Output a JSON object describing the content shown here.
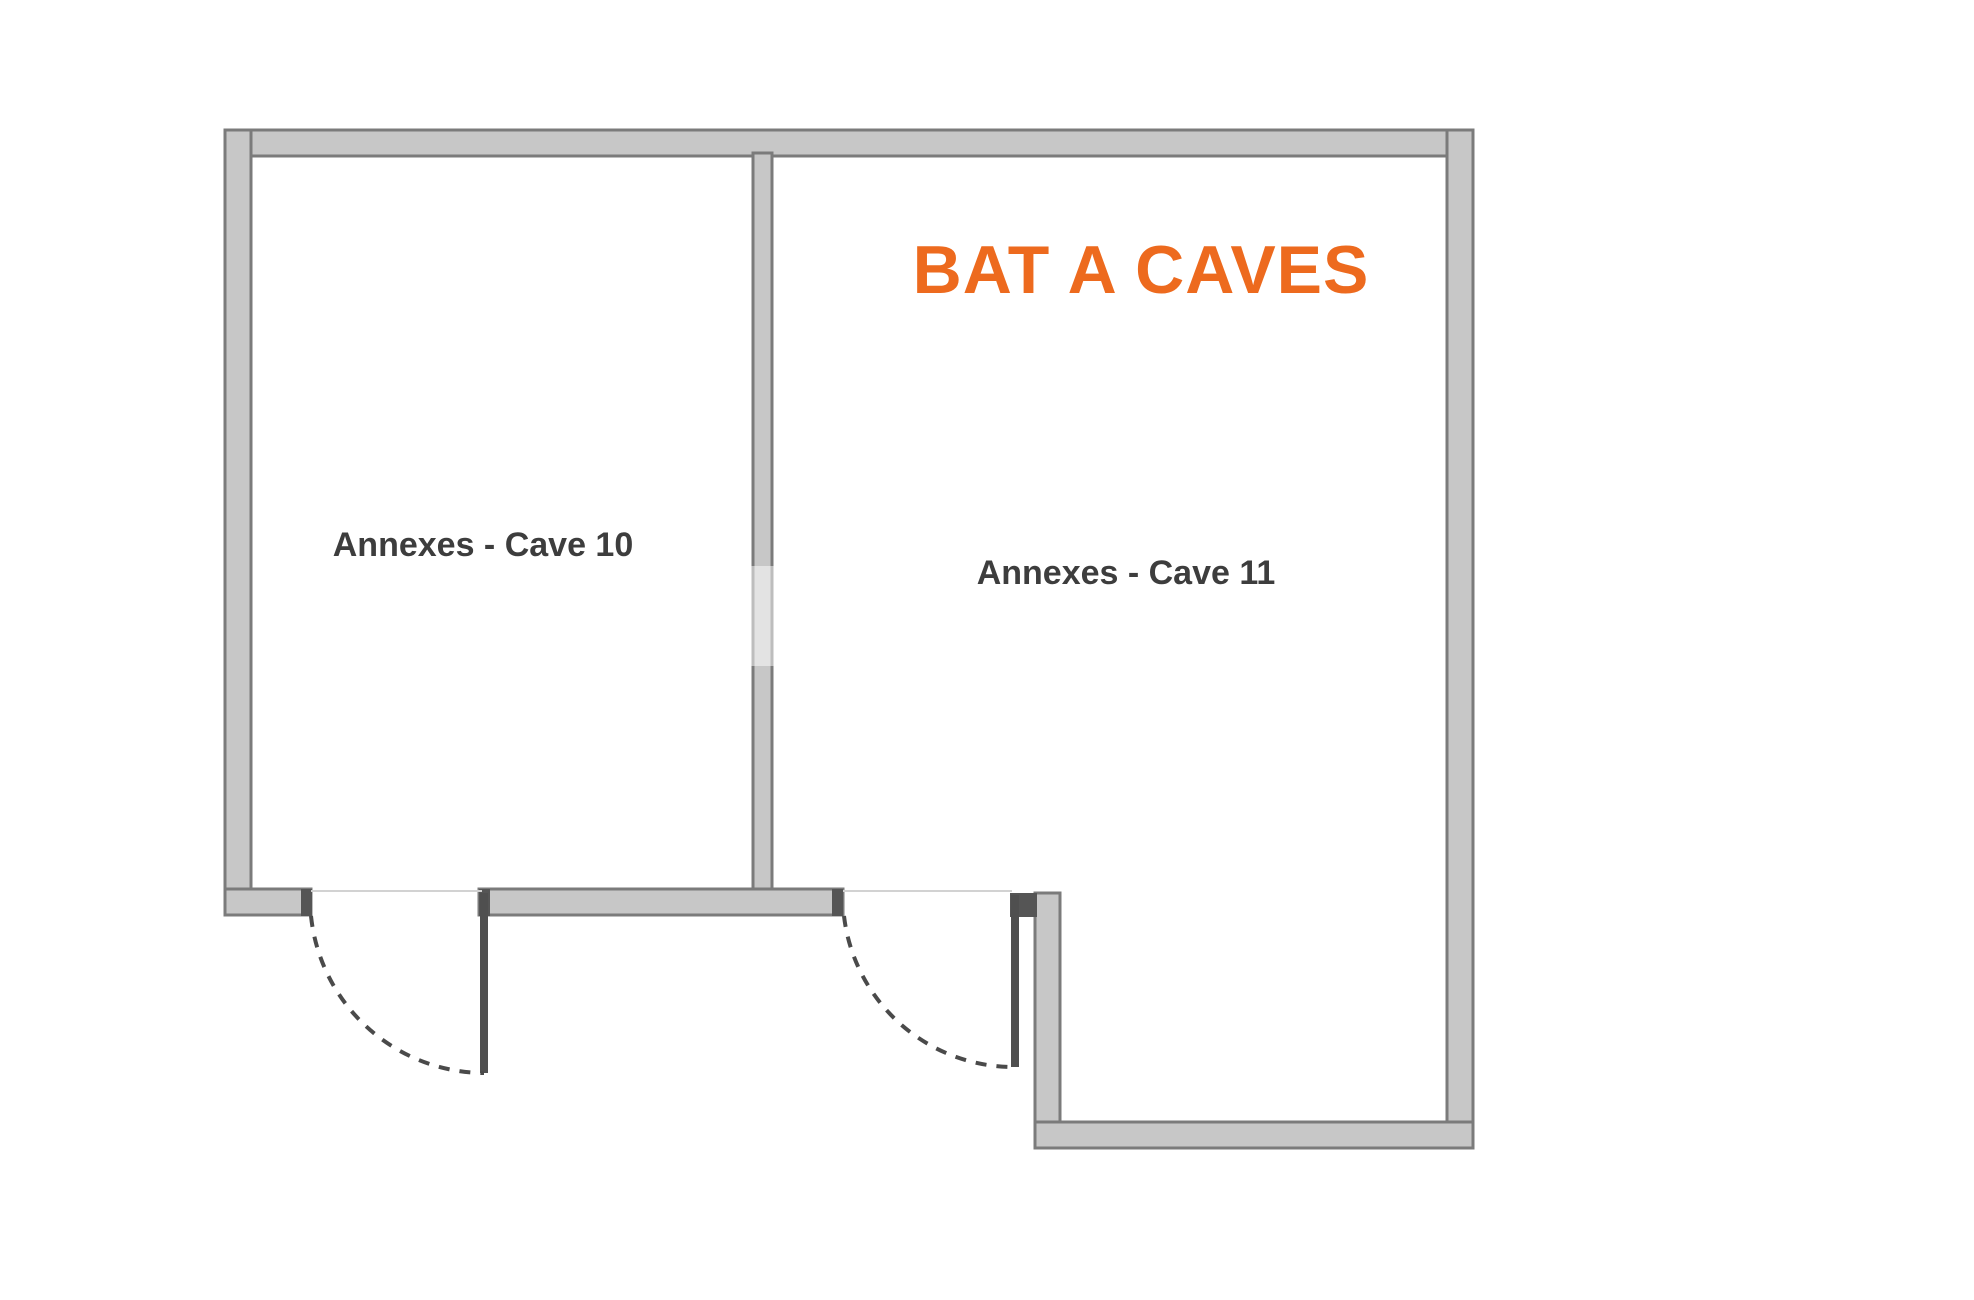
{
  "floor_plan": {
    "title": "BAT A CAVES",
    "title_color": "#ED6A1E",
    "rooms": [
      {
        "id": "cave-10",
        "label": "Annexes - Cave 10"
      },
      {
        "id": "cave-11",
        "label": "Annexes - Cave 11"
      }
    ],
    "colors": {
      "wall_fill": "#c7c7c7",
      "wall_edge": "#7b7b7b",
      "jamb_cap": "#555555",
      "door_leaf": "#4f4f4f",
      "door_swing_dash": "#4a4a4a",
      "threshold": "#d2d2d2",
      "room_label": "#3d3d3d",
      "background": "#ffffff"
    }
  }
}
